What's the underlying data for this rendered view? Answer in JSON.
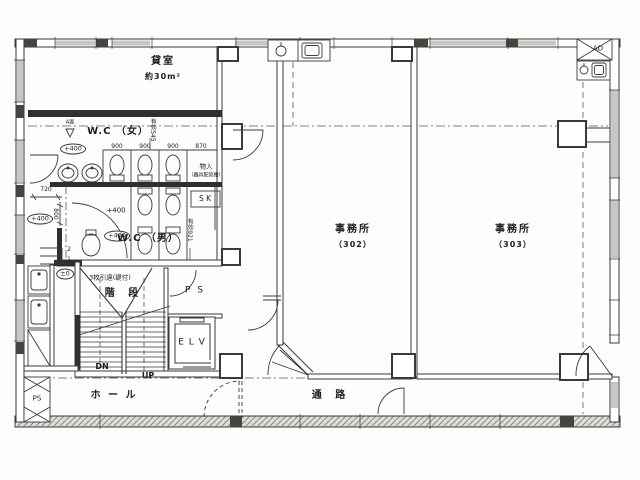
{
  "plan": {
    "rooms": {
      "rental": {
        "label": "貸室",
        "area": "約30m²"
      },
      "wc_women": {
        "label": "W.C （女）"
      },
      "wc_men": {
        "label": "W.C （男）"
      },
      "closet": {
        "label": "物入",
        "note": "（器具配管棚）"
      },
      "sk": {
        "label": "S K"
      },
      "stairs": {
        "label": "階 段",
        "note": "3枚引違(鍵付)",
        "down": "DN",
        "up": "UP"
      },
      "ps": {
        "label": "P S"
      },
      "ps_shaft": {
        "label": "PS"
      },
      "elevator": {
        "label": "E L V"
      },
      "hall": {
        "label": "ホ ー ル"
      },
      "corridor": {
        "label": "通 路"
      },
      "office302": {
        "label": "事務所",
        "number": "（302）"
      },
      "office303": {
        "label": "事務所",
        "number": "（303）"
      },
      "duct": {
        "label": "AD"
      }
    },
    "levels": {
      "plus400": "+400",
      "zero": "±0"
    },
    "dims": {
      "w720": "720",
      "w800": "800",
      "stalls": [
        "900",
        "900",
        "900",
        "870"
      ],
      "eff545": "有効545",
      "eff921": "有効921",
      "steps": [
        "2",
        "1"
      ],
      "section": "A面"
    }
  }
}
